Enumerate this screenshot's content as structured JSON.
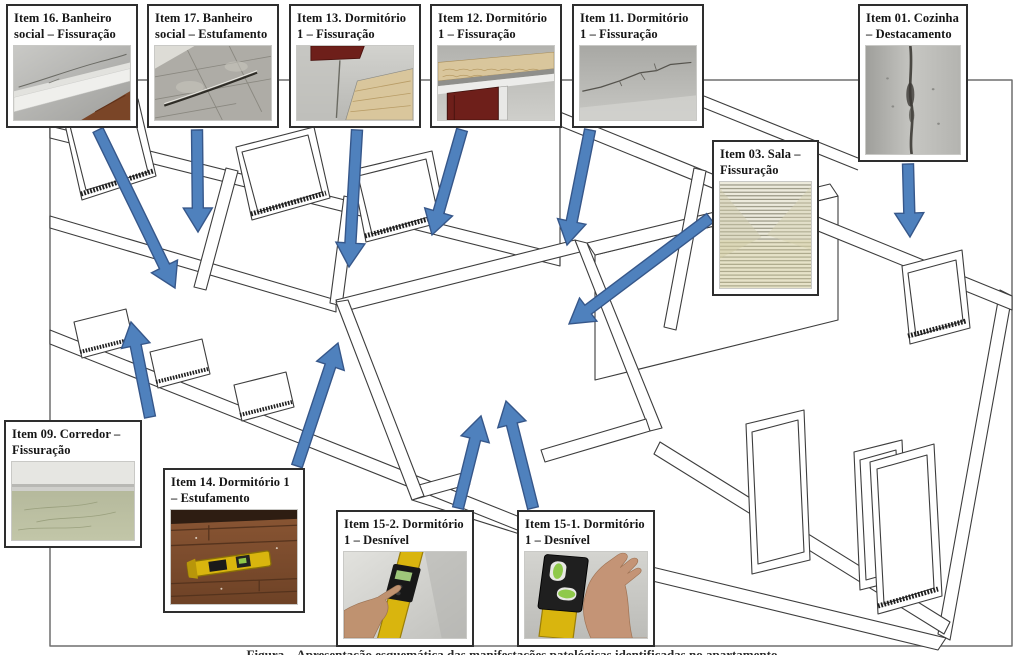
{
  "figure": {
    "caption": "Figura – Apresentação esquemática das manifestações patológicas identificadas no apartamento",
    "colors": {
      "arrow_fill": "#4f81bd",
      "arrow_stroke": "#36578a",
      "drawing_line": "#3d3d3d",
      "label_text": "#161616",
      "box_border": "#2e2e2e"
    }
  },
  "callouts": [
    {
      "id": "item-16",
      "label": "Item 16. Banheiro social – Fissuração",
      "photo": "ceiling-corner-crack"
    },
    {
      "id": "item-17",
      "label": "Item 17. Banheiro social – Estufamento",
      "photo": "bulged-floor-tiles-crack"
    },
    {
      "id": "item-13",
      "label": "Item 13. Dormitório 1 – Fissuração",
      "photo": "wall-corner-crack-door-frame"
    },
    {
      "id": "item-12",
      "label": "Item 12. Dormitório 1 – Fissuração",
      "photo": "exposed-brick-over-door"
    },
    {
      "id": "item-11",
      "label": "Item 11. Dormitório 1 – Fissuração",
      "photo": "horizontal-wall-crack"
    },
    {
      "id": "item-01",
      "label": "Item 01. Cozinha – Destacamento",
      "photo": "vertical-wall-detachment"
    },
    {
      "id": "item-03",
      "label": "Item 03. Sala – Fissuração",
      "photo": "blinds-wall-crack"
    },
    {
      "id": "item-09",
      "label": "Item 09. Corredor – Fissuração",
      "photo": "floor-crack-corridor"
    },
    {
      "id": "item-14",
      "label": "Item 14. Dormitório 1 – Estufamento",
      "photo": "spirit-level-on-wood-floor"
    },
    {
      "id": "item-15-2",
      "label": "Item 15-2. Dormitório 1 – Desnível",
      "photo": "hand-pointing-level-on-wall"
    },
    {
      "id": "item-15-1",
      "label": "Item 15-1. Dormitório 1 – Desnível",
      "photo": "hand-holding-level"
    }
  ]
}
